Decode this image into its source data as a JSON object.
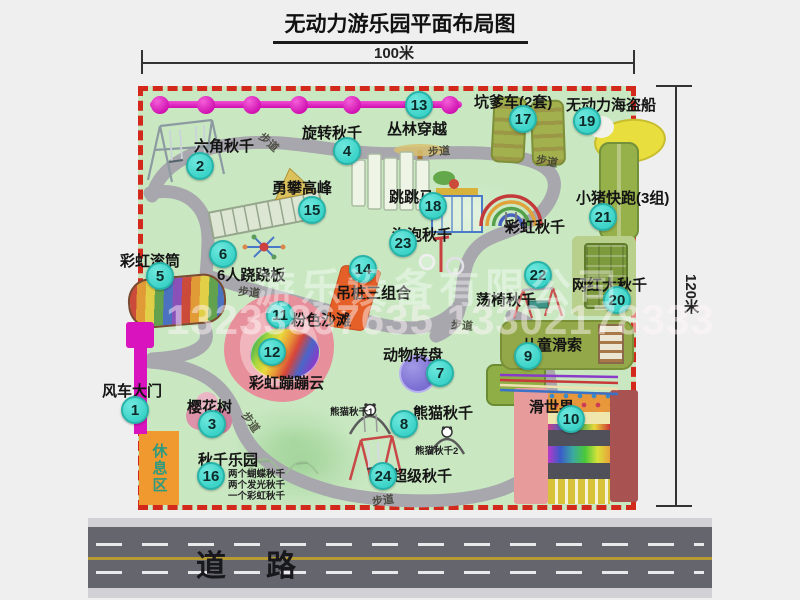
{
  "title": "无动力游乐园平面布局图",
  "dimensions": {
    "width": "100米",
    "height": "120米"
  },
  "road": {
    "label": "道路"
  },
  "walkway_label": "步道",
  "watermark": {
    "company": "游乐设备有限公司",
    "phones": "13233867635 13302178333"
  },
  "rest_area_label": "休息区",
  "extra_labels": {
    "rainbow_swing": "彩虹秋千",
    "panda_swing_1": "熊猫秋千1",
    "panda_swing_2": "熊猫秋千2"
  },
  "swing_park_notes": [
    "两个蝴蝶秋千",
    "两个发光秋千",
    "一个彩虹秋千"
  ],
  "attractions": [
    {
      "num": "1",
      "label": "风车大门"
    },
    {
      "num": "2",
      "label": "六角秋千"
    },
    {
      "num": "3",
      "label": "樱花树"
    },
    {
      "num": "4",
      "label": "旋转秋千"
    },
    {
      "num": "5",
      "label": "彩虹滚筒"
    },
    {
      "num": "6",
      "label": "6人跷跷板"
    },
    {
      "num": "7",
      "label": "动物转盘"
    },
    {
      "num": "8",
      "label": "熊猫秋千"
    },
    {
      "num": "9",
      "label": "儿童滑索"
    },
    {
      "num": "10",
      "label": "滑世界"
    },
    {
      "num": "11",
      "label": "粉色沙滩"
    },
    {
      "num": "12",
      "label": "彩虹蹦蹦云"
    },
    {
      "num": "13",
      "label": "丛林穿越"
    },
    {
      "num": "14",
      "label": "吊桩三组合"
    },
    {
      "num": "15",
      "label": "勇攀高峰"
    },
    {
      "num": "16",
      "label": "秋千乐园"
    },
    {
      "num": "17",
      "label": "坑爹车(2套)"
    },
    {
      "num": "18",
      "label": "跳跳马"
    },
    {
      "num": "19",
      "label": "无动力海盗船"
    },
    {
      "num": "20",
      "label": "网红大秋千"
    },
    {
      "num": "21",
      "label": "小猪快跑(3组)"
    },
    {
      "num": "22",
      "label": "荡椅秋千"
    },
    {
      "num": "23",
      "label": "泡泡秋千"
    },
    {
      "num": "24",
      "label": "超级秋千"
    }
  ],
  "colors": {
    "park_green": "#c9e8c2",
    "border_red": "#d3281c",
    "path_gray": "#a7a7ad",
    "marker_teal": "#3cd3c8",
    "gate_magenta": "#d913bd",
    "rest_orange": "#f0992e"
  }
}
